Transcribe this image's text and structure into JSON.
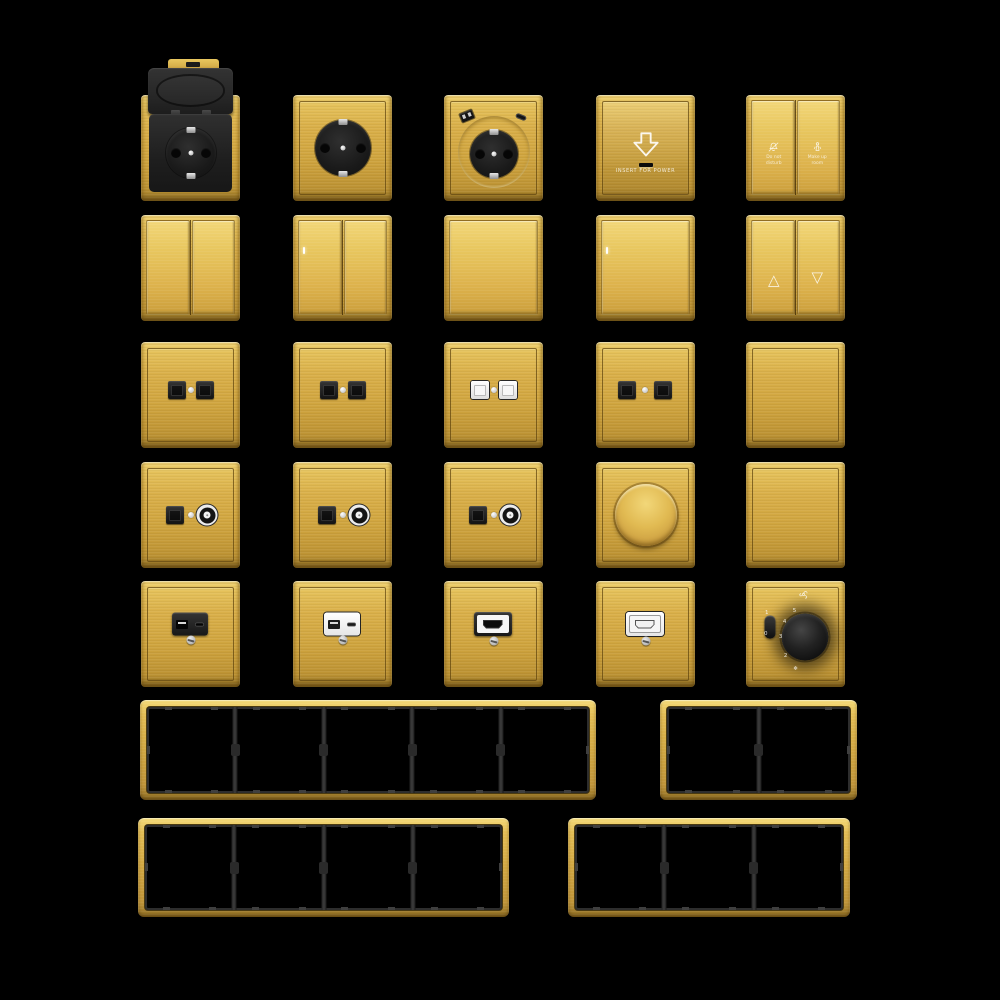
{
  "palette": {
    "background": "#000000",
    "gold": "#D9AF48",
    "gold_light": "#F1D475",
    "gold_dark": "#8F7026",
    "module_black": "#1E1E1E",
    "module_white": "#F2F2F2",
    "seam_brown": "#5C420C",
    "frame_opening_gray": "#3F3F3F"
  },
  "labels": {
    "keycard": "INSERT FOR POWER",
    "do_not_disturb": "Do not\ndisturb",
    "make_up_room": "Make up\nroom"
  },
  "icons": {
    "up": "△",
    "down": "▽",
    "snowflake": "❄"
  },
  "thermostat": {
    "slider_on": "1",
    "slider_off": "0",
    "scale": [
      "5",
      "4",
      "3",
      "2"
    ]
  },
  "devices": [
    {
      "name": "socket-flip-cover",
      "type": "flip",
      "row": 0,
      "col": 0
    },
    {
      "name": "socket-schuko",
      "type": "schuko",
      "row": 0,
      "col": 1
    },
    {
      "name": "socket-schuko-usb",
      "type": "schuko-usb",
      "row": 0,
      "col": 2
    },
    {
      "name": "keycard-power-holder",
      "type": "keycard",
      "row": 0,
      "col": 3
    },
    {
      "name": "hotel-service-switch",
      "type": "hotel",
      "row": 0,
      "col": 4
    },
    {
      "name": "switch-2gang",
      "type": "rocker2",
      "row": 1,
      "col": 0
    },
    {
      "name": "switch-2gang-indicator",
      "type": "rocker2-led",
      "row": 1,
      "col": 1
    },
    {
      "name": "switch-1gang",
      "type": "rocker1",
      "row": 1,
      "col": 2
    },
    {
      "name": "switch-1gang-indicator",
      "type": "rocker1-led",
      "row": 1,
      "col": 3
    },
    {
      "name": "curtain-switch",
      "type": "curtain",
      "row": 1,
      "col": 4
    },
    {
      "name": "data-socket-double-black-a",
      "type": "rj2-black",
      "row": 2,
      "col": 0
    },
    {
      "name": "data-socket-double-black-b",
      "type": "rj2-black",
      "row": 2,
      "col": 1
    },
    {
      "name": "data-socket-double-white",
      "type": "rj2-white",
      "row": 2,
      "col": 2
    },
    {
      "name": "data-socket-double-spaced",
      "type": "rj2-spaced",
      "row": 2,
      "col": 3
    },
    {
      "name": "blank-plate-a",
      "type": "blank",
      "row": 2,
      "col": 4
    },
    {
      "name": "tv-data-socket-a",
      "type": "tvdata",
      "row": 3,
      "col": 0
    },
    {
      "name": "tv-data-socket-b",
      "type": "tvdata",
      "row": 3,
      "col": 1
    },
    {
      "name": "tv-data-socket-c",
      "type": "tvdata",
      "row": 3,
      "col": 2
    },
    {
      "name": "rotary-dimmer",
      "type": "dimmer",
      "row": 3,
      "col": 3
    },
    {
      "name": "blank-plate-b",
      "type": "blank",
      "row": 3,
      "col": 4
    },
    {
      "name": "usb-charger-black",
      "type": "usb-black",
      "row": 4,
      "col": 0
    },
    {
      "name": "usb-charger-white",
      "type": "usb-white",
      "row": 4,
      "col": 1
    },
    {
      "name": "hdmi-socket-black",
      "type": "hdmi-black",
      "row": 4,
      "col": 2
    },
    {
      "name": "hdmi-socket-white",
      "type": "hdmi-white",
      "row": 4,
      "col": 3
    },
    {
      "name": "fan-speed-controller",
      "type": "thermostat",
      "row": 4,
      "col": 4
    }
  ],
  "frames": [
    {
      "name": "frame-5-gang",
      "gangs": 5
    },
    {
      "name": "frame-2-gang",
      "gangs": 2
    },
    {
      "name": "frame-4-gang",
      "gangs": 4
    },
    {
      "name": "frame-3-gang",
      "gangs": 3
    }
  ]
}
